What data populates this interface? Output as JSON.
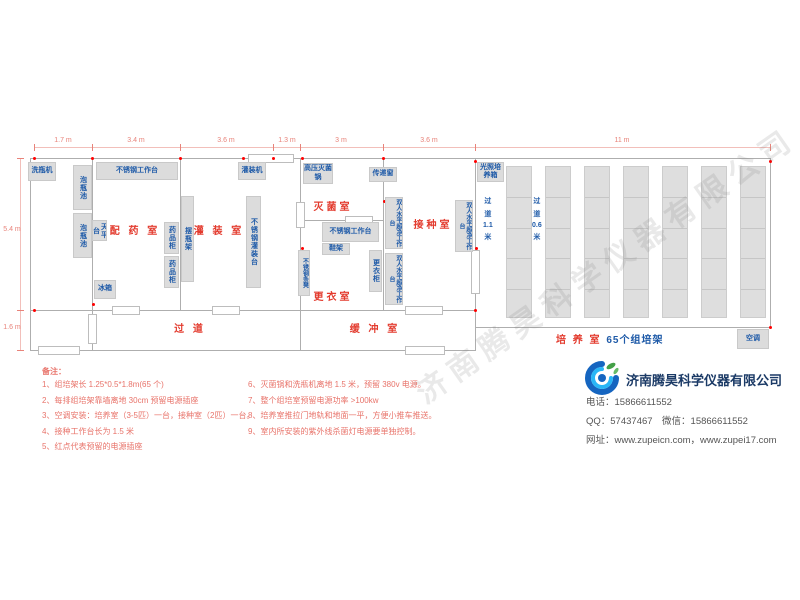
{
  "watermark": "济南腾昊科学仪器有限公司",
  "plan": {
    "dims": {
      "top_line": {
        "x": 34,
        "y": 147,
        "w": 736
      },
      "top_ticks": [
        34,
        92,
        180,
        273,
        300,
        383,
        475,
        770
      ],
      "top_labels": [
        {
          "text": "1.7 m",
          "x": 63
        },
        {
          "text": "3.4 m",
          "x": 136
        },
        {
          "text": "3.6 m",
          "x": 226
        },
        {
          "text": "1.3 m",
          "x": 287
        },
        {
          "text": "3 m",
          "x": 341
        },
        {
          "text": "3.6 m",
          "x": 429
        },
        {
          "text": "11 m",
          "x": 622
        }
      ],
      "left_line": {
        "x": 20,
        "y": 158,
        "h": 192
      },
      "left_ticks": [
        158,
        310,
        350
      ],
      "left_labels": [
        {
          "text": "5.4 m",
          "y": 226
        },
        {
          "text": "1.6 m",
          "y": 324
        }
      ]
    },
    "walls": [
      [
        30,
        158,
        741,
        1
      ],
      [
        30,
        158,
        1,
        193
      ],
      [
        30,
        350,
        446,
        1
      ],
      [
        770,
        158,
        1,
        170
      ],
      [
        475,
        327,
        296,
        1
      ],
      [
        92,
        158,
        1,
        193
      ],
      [
        180,
        158,
        1,
        153
      ],
      [
        300,
        158,
        1,
        193
      ],
      [
        383,
        158,
        1,
        153
      ],
      [
        475,
        158,
        1,
        193
      ],
      [
        30,
        310,
        446,
        1
      ],
      [
        302,
        220,
        81,
        1
      ]
    ],
    "doors": [
      [
        248,
        154,
        46,
        9
      ],
      [
        112,
        306,
        28,
        9
      ],
      [
        212,
        306,
        28,
        9
      ],
      [
        405,
        306,
        38,
        9
      ],
      [
        296,
        202,
        9,
        26
      ],
      [
        471,
        250,
        9,
        44
      ],
      [
        38,
        346,
        42,
        9
      ],
      [
        405,
        346,
        40,
        9
      ],
      [
        88,
        314,
        9,
        30
      ],
      [
        345,
        216,
        28,
        9
      ]
    ],
    "sockets": [
      [
        34,
        158
      ],
      [
        92,
        158
      ],
      [
        180,
        158
      ],
      [
        243,
        158
      ],
      [
        273,
        158
      ],
      [
        302,
        158
      ],
      [
        383,
        158
      ],
      [
        475,
        161
      ],
      [
        770,
        161
      ],
      [
        384,
        201
      ],
      [
        469,
        206
      ],
      [
        476,
        248
      ],
      [
        93,
        304
      ],
      [
        302,
        248
      ],
      [
        34,
        310
      ],
      [
        475,
        310
      ],
      [
        770,
        327
      ]
    ],
    "equipment": [
      {
        "id": "bottle-washer",
        "label": "洗瓶机",
        "x": 28,
        "y": 162,
        "w": 28,
        "h": 19,
        "o": "h"
      },
      {
        "id": "soak-pool-1",
        "label": "泡瓶池",
        "x": 73,
        "y": 165,
        "w": 19,
        "h": 45,
        "o": "v"
      },
      {
        "id": "soak-pool-2",
        "label": "泡瓶池",
        "x": 73,
        "y": 213,
        "w": 19,
        "h": 45,
        "o": "v"
      },
      {
        "id": "ss-workbench-top",
        "label": "不锈钢工作台",
        "x": 96,
        "y": 162,
        "w": 82,
        "h": 18,
        "o": "h"
      },
      {
        "id": "balance-table",
        "label": "天平台",
        "x": 92,
        "y": 220,
        "w": 15,
        "h": 21,
        "o": "v"
      },
      {
        "id": "fridge",
        "label": "冰箱",
        "x": 94,
        "y": 280,
        "w": 22,
        "h": 19,
        "o": "h"
      },
      {
        "id": "medicine-cabinet-1",
        "label": "药品柜",
        "x": 164,
        "y": 222,
        "w": 15,
        "h": 32,
        "o": "v"
      },
      {
        "id": "medicine-cabinet-2",
        "label": "药品柜",
        "x": 164,
        "y": 256,
        "w": 15,
        "h": 32,
        "o": "v"
      },
      {
        "id": "bottle-rack",
        "label": "摆瓶架",
        "x": 181,
        "y": 196,
        "w": 13,
        "h": 86,
        "o": "v"
      },
      {
        "id": "filling-machine",
        "label": "灌装机",
        "x": 238,
        "y": 162,
        "w": 28,
        "h": 18,
        "o": "h"
      },
      {
        "id": "ss-filling-bench",
        "label": "不锈钢灌装台",
        "x": 246,
        "y": 196,
        "w": 15,
        "h": 92,
        "o": "v"
      },
      {
        "id": "autoclave",
        "label": "高压灭菌锅",
        "x": 303,
        "y": 163,
        "w": 30,
        "h": 21,
        "o": "h"
      },
      {
        "id": "pass-through-window",
        "label": "传递窗",
        "x": 369,
        "y": 167,
        "w": 28,
        "h": 15,
        "o": "h"
      },
      {
        "id": "ss-workbench-mid",
        "label": "不锈钢工作台",
        "x": 322,
        "y": 222,
        "w": 57,
        "h": 20,
        "o": "h"
      },
      {
        "id": "shoe-rack",
        "label": "鞋架",
        "x": 322,
        "y": 243,
        "w": 28,
        "h": 12,
        "o": "h"
      },
      {
        "id": "ss-strip-bench",
        "label": "不锈钢条凳",
        "x": 298,
        "y": 250,
        "w": 12,
        "h": 46,
        "o": "v2"
      },
      {
        "id": "wardrobe",
        "label": "更衣柜",
        "x": 369,
        "y": 250,
        "w": 13,
        "h": 42,
        "o": "v"
      },
      {
        "id": "clean-bench-left-1",
        "label": "双人水平超净工作台",
        "x": 385,
        "y": 197,
        "w": 18,
        "h": 52,
        "o": "v2"
      },
      {
        "id": "clean-bench-left-2",
        "label": "双人水平超净工作台",
        "x": 385,
        "y": 253,
        "w": 18,
        "h": 52,
        "o": "v2"
      },
      {
        "id": "clean-bench-right",
        "label": "双人水平超净工作台",
        "x": 455,
        "y": 200,
        "w": 18,
        "h": 52,
        "o": "v2"
      },
      {
        "id": "light-incubator",
        "label": "光照培养箱",
        "x": 477,
        "y": 162,
        "w": 27,
        "h": 20,
        "o": "h"
      },
      {
        "id": "air-conditioner",
        "label": "空调",
        "x": 737,
        "y": 329,
        "w": 32,
        "h": 20,
        "o": "h"
      }
    ],
    "racks": {
      "xs": [
        506,
        545,
        584,
        623,
        662,
        701,
        740
      ],
      "y": 166,
      "w": 26,
      "h": 152,
      "segments": 5
    },
    "aisles": [
      {
        "id": "aisle-1-1m",
        "chars": [
          "过",
          "道",
          "1.1",
          "米"
        ],
        "x": 483,
        "y": 196
      },
      {
        "id": "aisle-0-6m",
        "chars": [
          "过",
          "道",
          "0.6",
          "米"
        ],
        "x": 532,
        "y": 196
      }
    ],
    "room_labels": [
      {
        "id": "room-label-dispensing",
        "text": "配 药 室",
        "x": 100,
        "y": 222,
        "w": 70
      },
      {
        "id": "room-label-filling",
        "text": "灌 装 室",
        "x": 188,
        "y": 222,
        "w": 62
      },
      {
        "id": "room-label-sterilization",
        "text": "灭菌室",
        "x": 306,
        "y": 198,
        "w": 54
      },
      {
        "id": "room-label-inoculation",
        "text": "接种室",
        "x": 403,
        "y": 216,
        "w": 60
      },
      {
        "id": "room-label-changing",
        "text": "更衣室",
        "x": 306,
        "y": 288,
        "w": 54
      },
      {
        "id": "room-label-corridor",
        "text": "过  道",
        "x": 140,
        "y": 320,
        "w": 100
      },
      {
        "id": "room-label-buffer",
        "text": "缓 冲 室",
        "x": 340,
        "y": 320,
        "w": 70
      }
    ],
    "culture_label": {
      "main": "培 养 室",
      "sub": "65个组培架",
      "x": 556,
      "y": 331
    }
  },
  "notes": {
    "title": "备注：",
    "left": [
      "1、组培架长 1.25*0.5*1.8m(65 个)",
      "2、每排组培架靠墙离地 30cm 预留电源插座",
      "3、空调安装：培养室（3-5匹）一台，接种室（2匹）一台。",
      "4、接种工作台长为 1.5 米",
      "5、红点代表预留的电源插座"
    ],
    "right": [
      "6、灭菌锅和洗瓶机离地 1.5 米，预留 380v 电源。",
      "7、整个组培室预留电源功率 >100kw",
      "8、培养室推拉门地轨和地面一平，方便小推车推送。",
      "9、室内所安装的紫外线杀菌灯电源要单独控制。"
    ]
  },
  "company": {
    "name": "济南腾昊科学仪器有限公司",
    "lines": [
      "电话：15866611552",
      "QQ：57437467　微信：15866611552",
      "网址：www.zupeicn.com，www.zupei17.com"
    ],
    "logo_colors": {
      "blue": "#1565c0",
      "light_blue": "#29b6f6",
      "green": "#43a047"
    }
  }
}
